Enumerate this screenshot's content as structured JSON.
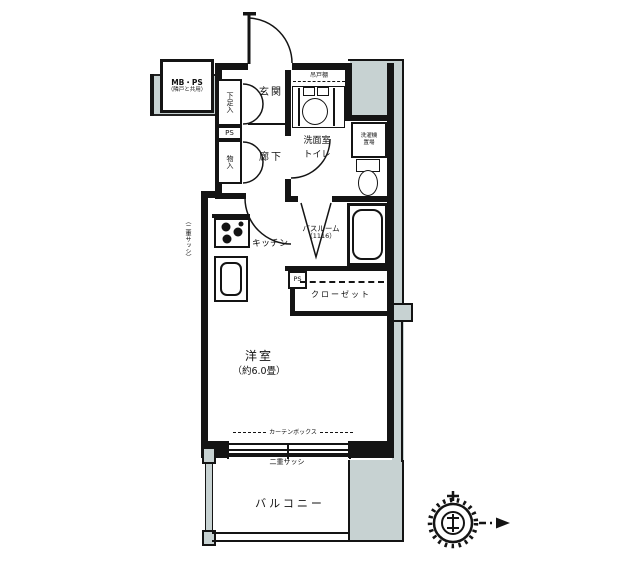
{
  "colors": {
    "wall": "#141414",
    "exterior_shade": "#c7d2d2",
    "background": "#ffffff"
  },
  "rooms": {
    "entrance": {
      "label": "玄関"
    },
    "hallway": {
      "label": "廊下"
    },
    "washroom_toilet": {
      "line1": "洗面室",
      "line2": "トイレ"
    },
    "bathroom": {
      "label": "バスルーム",
      "size": "（1116）"
    },
    "kitchen": {
      "label": "キッチン"
    },
    "closet": {
      "label": "クローゼット"
    },
    "western_room": {
      "label": "洋室",
      "size": "（約6.0畳）"
    },
    "balcony": {
      "label": "バルコニー"
    }
  },
  "fixtures": {
    "meter_box": {
      "line1": "MB・PS",
      "line2": "（隣戸と共用）"
    },
    "shoe_cabinet": {
      "label": "下足入"
    },
    "pipe_space_upper": {
      "label": "PS"
    },
    "storage": {
      "label": "物入"
    },
    "hanging_cupboard": {
      "label": "吊戸棚"
    },
    "washing_machine": {
      "line1": "洗濯機",
      "line2": "置場"
    },
    "pipe_space_lower": {
      "label": "PS"
    }
  },
  "annotations": {
    "curtain_box": {
      "label": "カーテンボックス"
    },
    "window_bottom": {
      "label": "二重サッシ"
    },
    "window_side": {
      "label": "（二重サッシ）"
    }
  }
}
